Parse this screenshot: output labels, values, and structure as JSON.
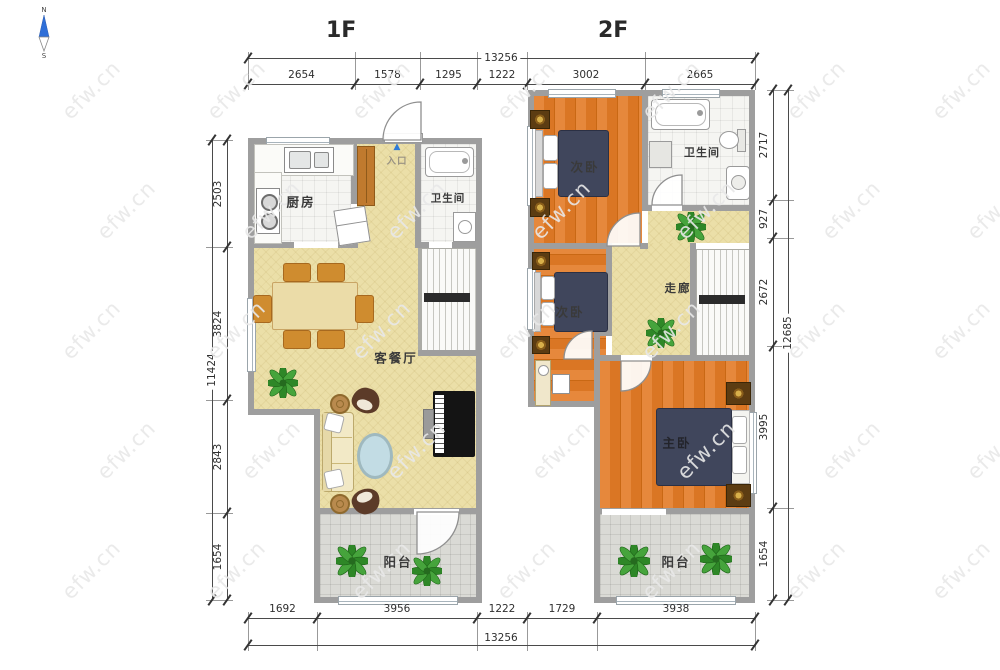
{
  "compass": {
    "north": "N",
    "south": "S"
  },
  "watermark": {
    "text": "efw.cn"
  },
  "floor1": {
    "title": "1F",
    "rooms": {
      "kitchen": "厨房",
      "bathroom": "卫生间",
      "living_dining": "客餐厅",
      "balcony": "阳台",
      "entrance": "入口",
      "entrance_arrow": "▲"
    }
  },
  "floor2": {
    "title": "2F",
    "rooms": {
      "bedroom_a": "次卧",
      "bathroom": "卫生间",
      "corridor": "走廊",
      "bedroom_b": "次卧",
      "master_bedroom": "主卧",
      "balcony": "阳台"
    }
  },
  "dimensions": {
    "top": {
      "overall": "13256",
      "segments": [
        "2654",
        "1578",
        "1295",
        "1222",
        "3002",
        "2665"
      ]
    },
    "bottom": {
      "overall": "13256",
      "segments": [
        "1692",
        "3956",
        "1222",
        "1729",
        "3938"
      ]
    },
    "left": {
      "overall": "11424",
      "segments": [
        "2503",
        "3824",
        "2843",
        "1654"
      ]
    },
    "right": {
      "overall": "12685",
      "segments": [
        "2717",
        "927",
        "2672",
        "3995",
        "1654"
      ]
    }
  }
}
